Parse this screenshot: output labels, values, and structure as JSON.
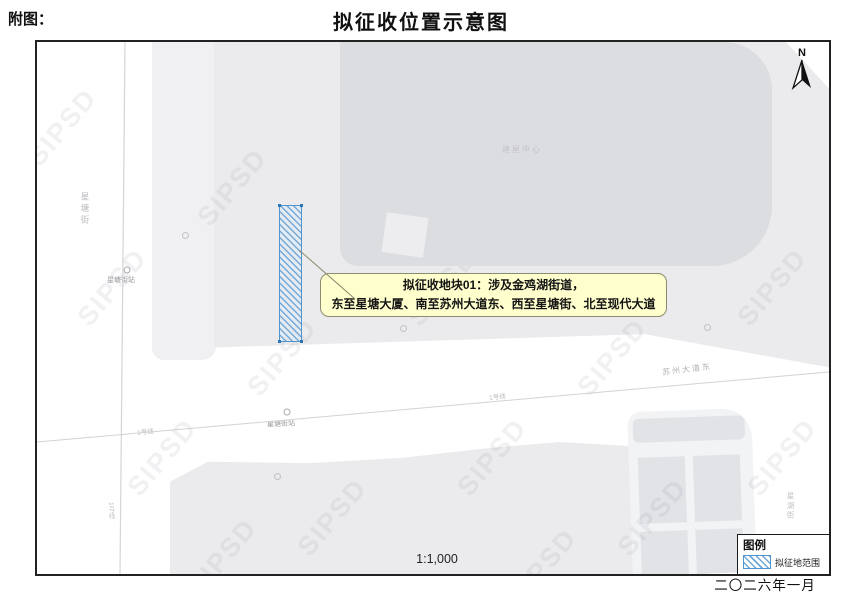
{
  "page": {
    "figure_label": "附图：",
    "title": "拟征收位置示意图",
    "scale": "1:1,000",
    "date": "二〇二六年一月"
  },
  "north": {
    "label": "N"
  },
  "callout": {
    "line1": "拟征收地块01：涉及金鸡湖街道，",
    "line2": "东至星塘大厦、南至苏州大道东、西至星塘街、北至现代大道"
  },
  "legend": {
    "title": "图例",
    "items": [
      {
        "label": "拟征地范围",
        "swatch": "blue-hatch"
      }
    ]
  },
  "labels": {
    "street_left": "星塘街",
    "street_right": "星湖街",
    "station_left": "星塘街站",
    "station_mid": "星塘街站",
    "metro_line": "1号线",
    "road_diagonal": "苏州大道东",
    "building": "建屋中心"
  },
  "watermark": {
    "text": "SIPSD"
  },
  "colors": {
    "parcel_outline": "#4f94cd",
    "parcel_hatch": "#74a9d8",
    "callout_bg": "#ffffcc",
    "parcel_fill": "#ebebee",
    "building_fill": "#dcdde1"
  }
}
